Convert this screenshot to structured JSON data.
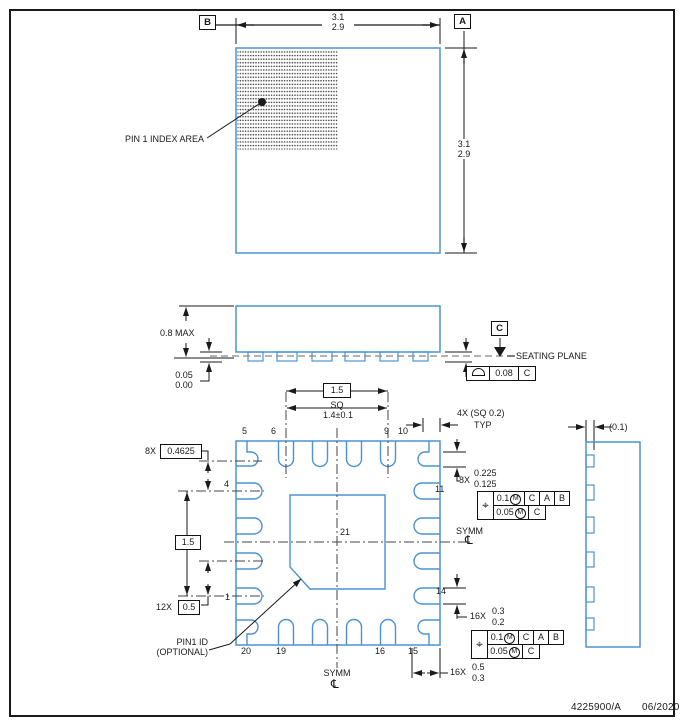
{
  "footer": {
    "doc": "4225900/A",
    "date": "06/2020"
  },
  "datum_labels": {
    "a": "A",
    "b": "B",
    "c": "C"
  },
  "symbols": {
    "position": "⌖",
    "max_material": "M",
    "centerline": "℄"
  },
  "top_view": {
    "pin1_index_label": "PIN 1 INDEX AREA",
    "width_max": "3.1",
    "width_min": "2.9",
    "height_max": "3.1",
    "height_min": "2.9"
  },
  "side_view": {
    "body_height": "0.8 MAX",
    "standoff_max": "0.05",
    "standoff_min": "0.00",
    "seating_plane_label": "SEATING PLANE",
    "flatness_tol": "0.08",
    "flatness_datum": "C"
  },
  "bottom_view": {
    "pad_size_basic": "1.5",
    "sq_label": "SQ",
    "pad_size_tol": "1.4±0.1",
    "corner_note": "4X (SQ 0.2)",
    "typ_label": "TYP",
    "corner_pitch_count": "8X",
    "corner_pitch": "0.4625",
    "pad_width_count": "8X",
    "pad_width_max": "0.225",
    "pad_width_min": "0.125",
    "pitch_span": "1.5",
    "pitch_count": "12X",
    "pitch": "0.5",
    "pin1_id_line1": "PIN1 ID",
    "pin1_id_line2": "(OPTIONAL)",
    "symm_label": "SYMM",
    "lead_width_count": "16X",
    "lead_width_max": "0.3",
    "lead_width_min": "0.2",
    "lead_length_count": "16X",
    "lead_length_max": "0.5",
    "lead_length_min": "0.3",
    "thermal_pad_number": "21",
    "pin_numbers": {
      "p1": "1",
      "p4": "4",
      "p5": "5",
      "p6": "6",
      "p9": "9",
      "p10": "10",
      "p11": "11",
      "p14": "14",
      "p15": "15",
      "p16": "16",
      "p19": "19",
      "p20": "20"
    }
  },
  "detail_view": {
    "lead_thickness": "(0.1)"
  },
  "position_fcf": {
    "tol1": "0.1",
    "tol2": "0.05",
    "datum_c": "C",
    "datum_a": "A",
    "datum_b": "B"
  }
}
